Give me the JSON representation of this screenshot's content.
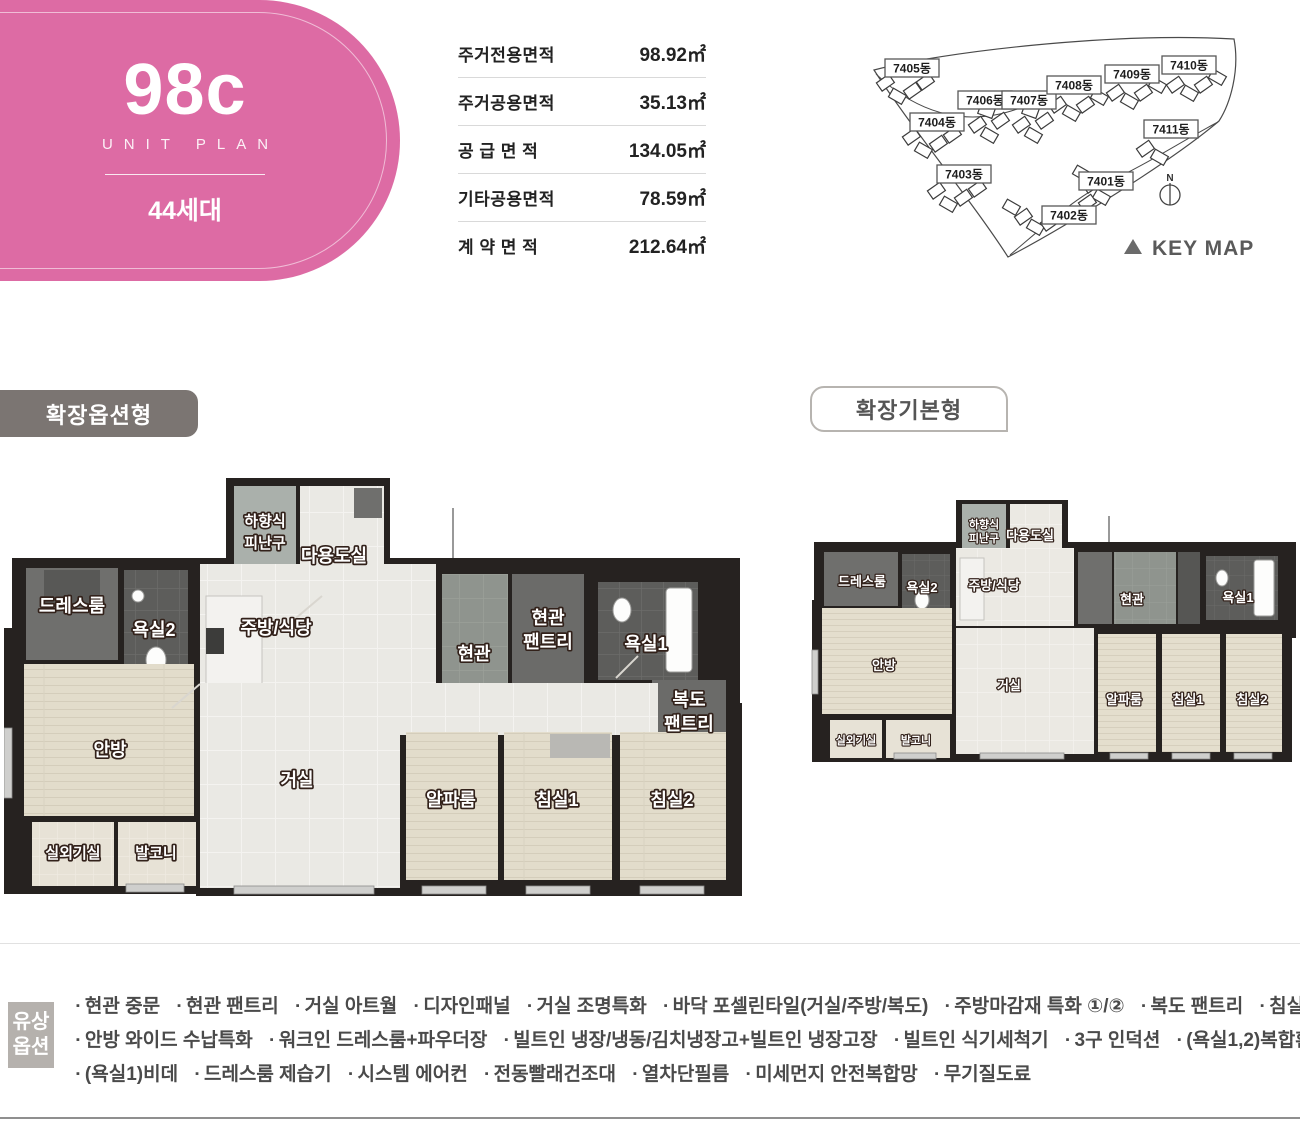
{
  "colors": {
    "brand_pink": "#dd6ba4",
    "keymap_highlight": "#d6579f",
    "section_badge_gray": "#7b7572"
  },
  "unit_badge": {
    "code": "98c",
    "subtitle": "UNIT PLAN",
    "households": "44세대"
  },
  "area_table": {
    "rows": [
      {
        "label": "주거전용면적",
        "value": "98.92㎡"
      },
      {
        "label": "주거공용면적",
        "value": "35.13㎡"
      },
      {
        "label": "공 급 면 적",
        "value": "134.05㎡"
      },
      {
        "label": "기타공용면적",
        "value": "78.59㎡"
      },
      {
        "label": "계 약 면 적",
        "value": "212.64㎡"
      }
    ]
  },
  "keymap": {
    "caption": "KEY MAP",
    "north_label": "N",
    "buildings": [
      {
        "label": "7405동",
        "highlighted": true
      },
      {
        "label": "7404동",
        "highlighted": true
      },
      {
        "label": "7403동",
        "highlighted": true
      },
      {
        "label": "7406동",
        "highlighted": false
      },
      {
        "label": "7407동",
        "highlighted": false
      },
      {
        "label": "7408동",
        "highlighted": false
      },
      {
        "label": "7409동",
        "highlighted": false
      },
      {
        "label": "7410동",
        "highlighted": false
      },
      {
        "label": "7411동",
        "highlighted": false
      },
      {
        "label": "7401동",
        "highlighted": false
      },
      {
        "label": "7402동",
        "highlighted": false
      }
    ]
  },
  "plans": {
    "left": {
      "badge": "확장옵션형",
      "rooms": {
        "hatch1": "하향식",
        "hatch2": "피난구",
        "utility": "다용도실",
        "dressroom": "드레스룸",
        "bath2": "욕실2",
        "kitchen": "주방/식당",
        "entry": "현관",
        "entry_pantry1": "현관",
        "entry_pantry2": "팬트리",
        "bath1": "욕실1",
        "hall_pantry1": "복도",
        "hall_pantry2": "팬트리",
        "master": "안방",
        "living": "거실",
        "alpha": "알파룸",
        "bed1": "침실1",
        "bed2": "침실2",
        "ac_room": "실외기실",
        "balcony": "발코니"
      }
    },
    "right": {
      "badge": "확장기본형",
      "rooms": {
        "hatch1": "하향식",
        "hatch2": "피난구",
        "utility": "다용도실",
        "dressroom": "드레스룸",
        "bath2": "욕실2",
        "kitchen": "주방/식당",
        "entry": "현관",
        "bath1": "욕실1",
        "master": "안방",
        "living": "거실",
        "alpha": "알파룸",
        "bed1": "침실1",
        "bed2": "침실2",
        "ac_room": "실외기실",
        "balcony": "발코니"
      }
    }
  },
  "options": {
    "title_line1": "유상",
    "title_line2": "옵션",
    "groups": [
      [
        "현관 중문",
        "현관 팬트리",
        "거실 아트월",
        "디자인패널",
        "거실 조명특화",
        "바닥 포셀린타일(거실/주방/복도)",
        "주방마감재 특화 ①/②",
        "복도 팬트리",
        "침실1 붙박이장"
      ],
      [
        "안방 와이드 수납특화",
        "워크인 드레스룸+파우더장",
        "빌트인 냉장/냉동/김치냉장고+빌트인 냉장고장",
        "빌트인 식기세척기",
        "3구 인덕션",
        "(욕실1,2)복합환풍기"
      ],
      [
        "(욕실1)비데",
        "드레스룸 제습기",
        "시스템 에어컨",
        "전동빨래건조대",
        "열차단필름",
        "미세먼지 안전복합망",
        "무기질도료"
      ]
    ]
  }
}
